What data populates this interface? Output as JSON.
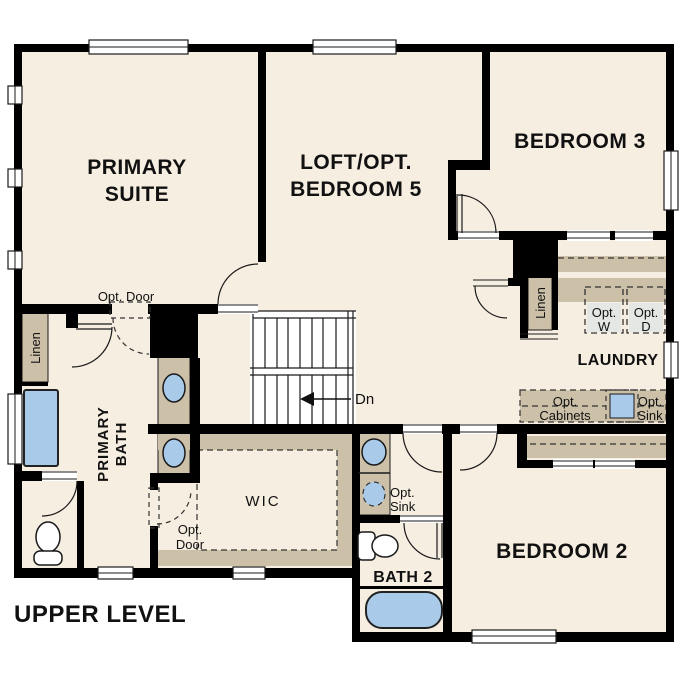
{
  "plan": {
    "title": "UPPER LEVEL",
    "rooms": {
      "primary_suite": {
        "line1": "PRIMARY",
        "line2": "SUITE"
      },
      "loft": {
        "line1": "LOFT/OPT.",
        "line2": "BEDROOM 5"
      },
      "bedroom3": {
        "label": "BEDROOM 3"
      },
      "laundry": {
        "label": "LAUNDRY"
      },
      "primary_bath": {
        "line1": "PRIMARY",
        "line2": "BATH"
      },
      "wic": {
        "label": "WIC"
      },
      "bath2": {
        "label": "BATH 2"
      },
      "bedroom2": {
        "label": "BEDROOM 2"
      }
    },
    "callouts": {
      "linen_primary": "Linen",
      "linen_laundry": "Linen",
      "opt_door_primary": "Opt. Door",
      "opt_door_wic": {
        "line1": "Opt.",
        "line2": "Door"
      },
      "opt_washer": {
        "line1": "Opt.",
        "line2": "W"
      },
      "opt_dryer": {
        "line1": "Opt.",
        "line2": "D"
      },
      "opt_cabinets": {
        "line1": "Opt.",
        "line2": "Cabinets"
      },
      "opt_sink_laundry": {
        "line1": "Opt.",
        "line2": "Sink"
      },
      "opt_sink_bath2": {
        "line1": "Opt.",
        "line2": "Sink"
      },
      "stairs_down": "Dn"
    },
    "colors": {
      "floor": "#f6eee1",
      "cabinet_tan": "#ccc0a8",
      "fixture_blue": "#a9cbe9",
      "appliance_gray": "#e4e7e3",
      "wall": "#000000"
    }
  }
}
